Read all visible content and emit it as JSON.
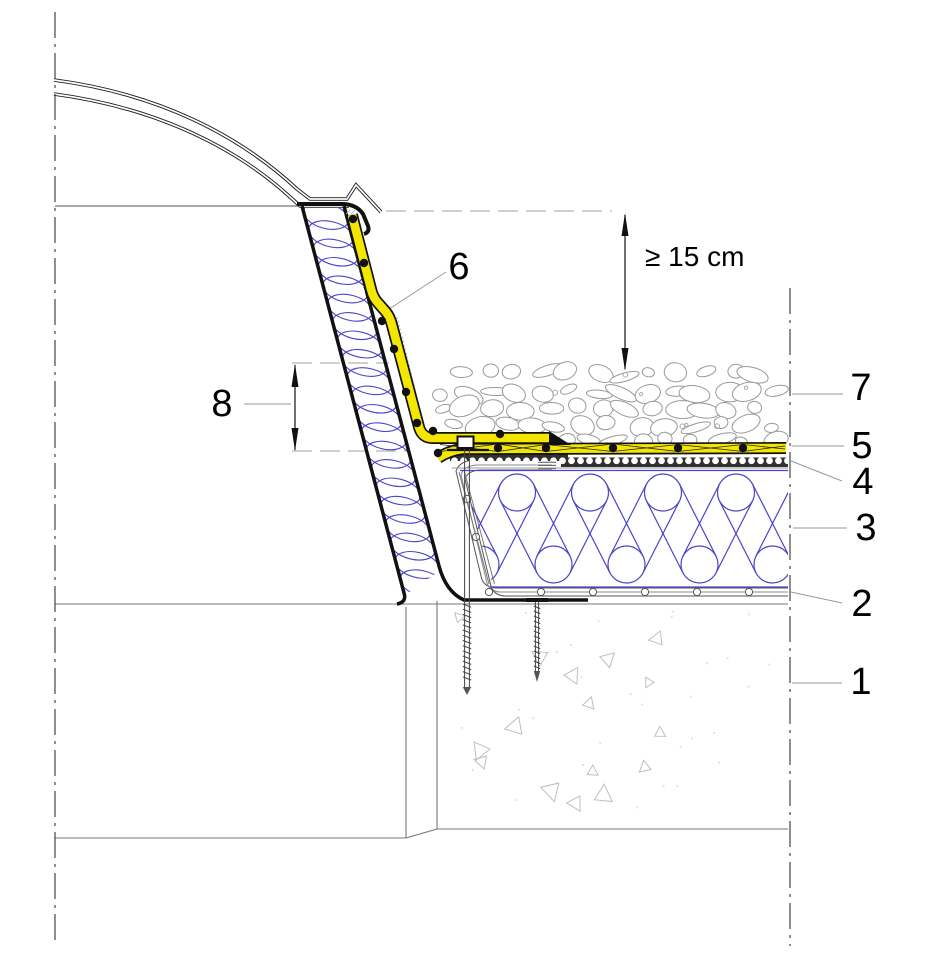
{
  "page": {
    "background": "#ffffff"
  },
  "drawing": {
    "type": "architectural-section-detail",
    "dimension": {
      "min_height": "≥ 15 cm"
    },
    "callouts": {
      "c1": "1",
      "c2": "2",
      "c3": "3",
      "c4": "4",
      "c5": "5",
      "c6": "6",
      "c7": "7",
      "c8": "8"
    },
    "colors": {
      "membrane_yellow": "#f3e600",
      "insulation_blue": "#4a43c9",
      "line_dark": "#1a1a1a",
      "hatch_gray": "#999999"
    }
  }
}
